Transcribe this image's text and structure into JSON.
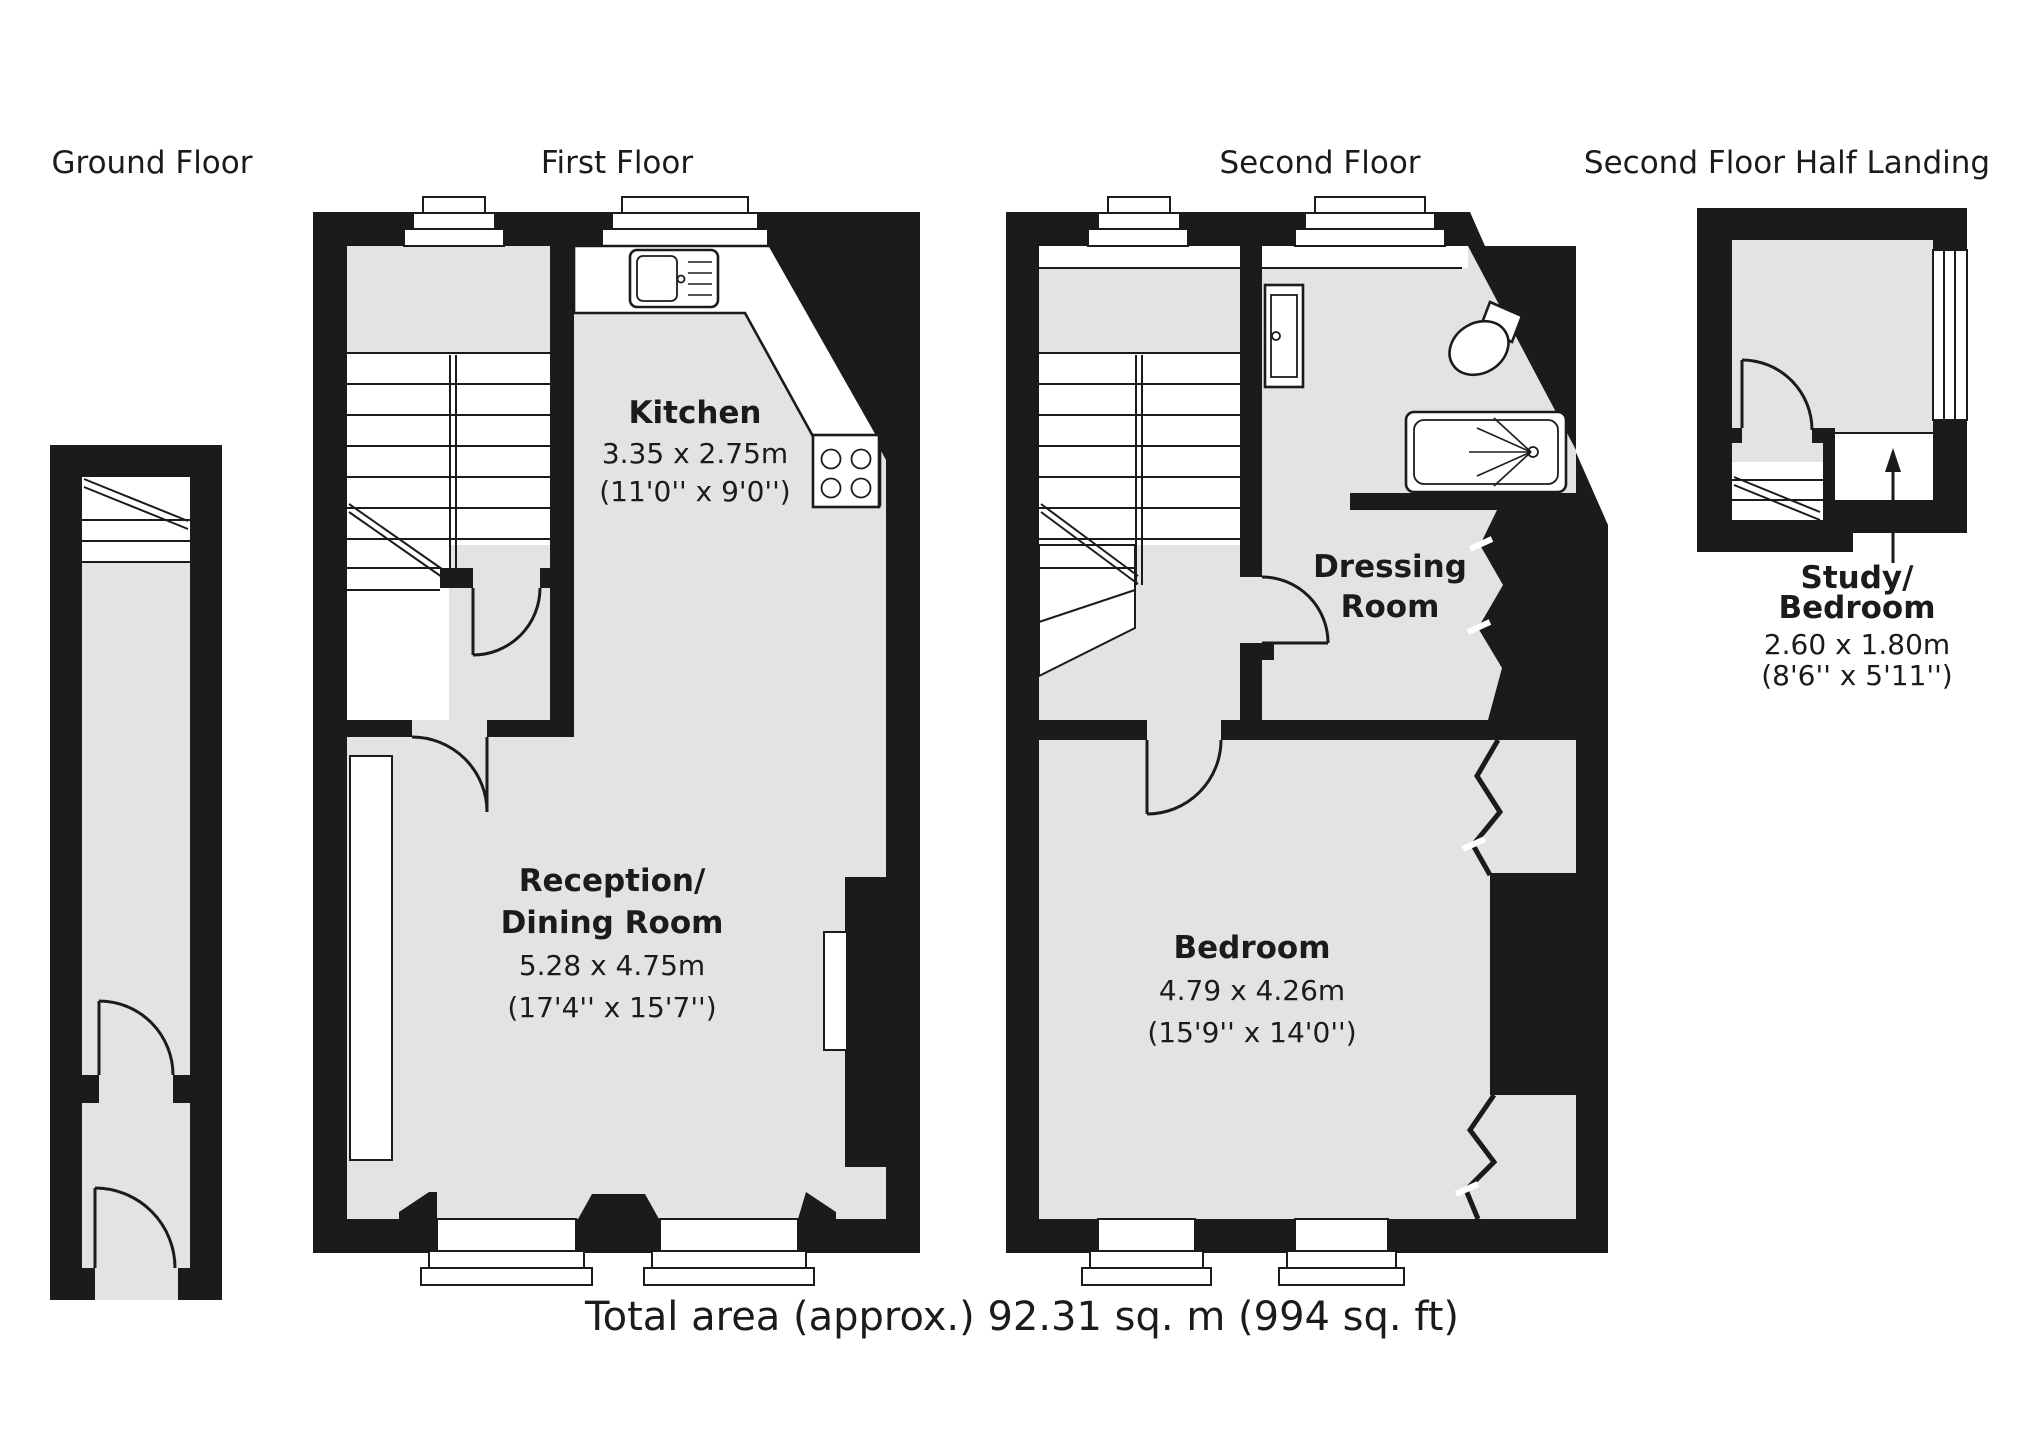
{
  "floor_labels": {
    "ground": "Ground Floor",
    "first": "First Floor",
    "second": "Second Floor",
    "half_landing": "Second Floor Half Landing"
  },
  "rooms": {
    "kitchen": {
      "name": "Kitchen",
      "size_metric": "3.35 x 2.75m",
      "size_imperial": "(11'0'' x 9'0'')"
    },
    "reception_dining": {
      "name_line1": "Reception/",
      "name_line2": "Dining Room",
      "size_metric": "5.28 x 4.75m",
      "size_imperial": "(17'4'' x 15'7'')"
    },
    "dressing_room": {
      "name_line1": "Dressing",
      "name_line2": "Room"
    },
    "bedroom": {
      "name": "Bedroom",
      "size_metric": "4.79 x 4.26m",
      "size_imperial": "(15'9'' x 14'0'')"
    },
    "study_bedroom": {
      "name_line1": "Study/",
      "name_line2": "Bedroom",
      "size_metric": "2.60 x 1.80m",
      "size_imperial": "(8'6'' x 5'11'')"
    }
  },
  "footer": {
    "total_area": "Total area (approx.) 92.31 sq. m (994 sq. ft)"
  },
  "fixtures": {
    "sink": "kitchen-sink",
    "hob": "four-ring-hob",
    "bath": "bathtub-with-shower",
    "toilet": "toilet",
    "basin": "wash-basin"
  },
  "colors": {
    "wall": "#1b1b1d",
    "floor": "#e3e3e6",
    "ink": "#1b1b1d",
    "fixture": "#ffffff",
    "background": "#ffffff"
  }
}
